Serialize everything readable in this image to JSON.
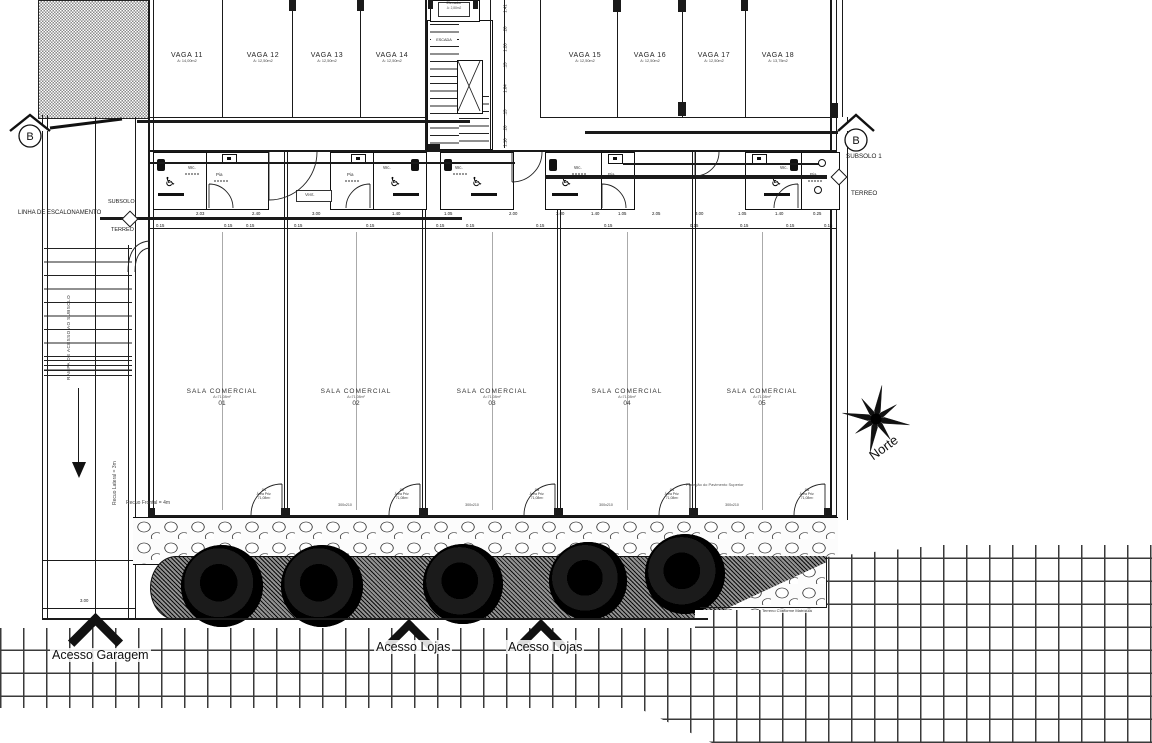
{
  "section_marker": "B",
  "site": {
    "north_label": "Norte",
    "terrain_note": "Terreno Conforme Matrícula",
    "access_garage": "Acesso Garagem",
    "access_shops_1": "Acesso Lojas",
    "access_shops_2": "Acesso Lojas",
    "setback_lateral": "Recuo Lateral = 3m",
    "setback_frontal": "Recuo Frontal = 4m",
    "left_bottom_dim": "3.00"
  },
  "levels": {
    "left_line_label": "LINHA DE ESCALONAMENTO",
    "left_above": "SUBSOLO",
    "left_below": "TERREO",
    "right_above": "SUBSOLO 1",
    "right_below": "TERREO"
  },
  "garage": {
    "ramp_label": "RAMPA DE ACESSO AO SUBSOLO",
    "spaces": [
      {
        "name": "VAGA 11",
        "area": "A: 14,00m2"
      },
      {
        "name": "VAGA 12",
        "area": "A: 12,50m2"
      },
      {
        "name": "VAGA 13",
        "area": "A: 12,50m2"
      },
      {
        "name": "VAGA 14",
        "area": "A: 12,50m2"
      },
      {
        "name": "VAGA 15",
        "area": "A: 12,50m2"
      },
      {
        "name": "VAGA 16",
        "area": "A: 12,50m2"
      },
      {
        "name": "VAGA 17",
        "area": "A: 12,50m2"
      },
      {
        "name": "VAGA 18",
        "area": "A: 13,75m2"
      }
    ]
  },
  "core": {
    "elevator_label": "Elevador",
    "elevator_area": "A: 2,88m2",
    "stair_label": "ESCADA"
  },
  "bathrooms": {
    "wc_label": "Wc.",
    "pia_label": "Pia",
    "vent_label": "Vent."
  },
  "rooms": {
    "title": "SALA COMERCIAL",
    "area": "A=71,08m²",
    "numbers": [
      "01",
      "02",
      "03",
      "04",
      "05"
    ],
    "projection_note": "Projeção do Pavimento Superior",
    "door_tag_title": "Área Priv.",
    "door_tag_area": "71,08m²",
    "window_size": "300x210"
  },
  "dims": {
    "bottom_values": [
      {
        "x": 196,
        "v": "2.03"
      },
      {
        "x": 252,
        "v": "2.40"
      },
      {
        "x": 312,
        "v": "3.00"
      },
      {
        "x": 392,
        "v": "1.40"
      },
      {
        "x": 444,
        "v": "1.05"
      },
      {
        "x": 509,
        "v": "2.00"
      },
      {
        "x": 556,
        "v": "3.00"
      },
      {
        "x": 591,
        "v": "1.40"
      },
      {
        "x": 618,
        "v": "1.05"
      },
      {
        "x": 652,
        "v": "2.05"
      },
      {
        "x": 695,
        "v": "3.00"
      },
      {
        "x": 738,
        "v": "1.05"
      },
      {
        "x": 775,
        "v": "1.40"
      },
      {
        "x": 813,
        "v": "0.25"
      }
    ],
    "bottom_small": [
      {
        "x": 156,
        "v": "0.15"
      },
      {
        "x": 224,
        "v": "0.15"
      },
      {
        "x": 246,
        "v": "0.15"
      },
      {
        "x": 294,
        "v": "0.15"
      },
      {
        "x": 366,
        "v": "0.15"
      },
      {
        "x": 436,
        "v": "0.15"
      },
      {
        "x": 466,
        "v": "0.15"
      },
      {
        "x": 536,
        "v": "0.15"
      },
      {
        "x": 604,
        "v": "0.15"
      },
      {
        "x": 690,
        "v": "0.15"
      },
      {
        "x": 740,
        "v": "0.15"
      },
      {
        "x": 786,
        "v": "0.15"
      },
      {
        "x": 824,
        "v": "0.15"
      }
    ],
    "stair_right": [
      {
        "x": 497,
        "y": 6,
        "v": "1.41"
      },
      {
        "x": 497,
        "y": 27,
        "v": ".20"
      },
      {
        "x": 497,
        "y": 45,
        "v": "1.20"
      },
      {
        "x": 497,
        "y": 63,
        "v": ".15"
      },
      {
        "x": 497,
        "y": 86,
        "v": "1.04"
      },
      {
        "x": 497,
        "y": 110,
        "v": ".15"
      },
      {
        "x": 497,
        "y": 126,
        "v": ".20"
      },
      {
        "x": 497,
        "y": 140,
        "v": "1.10"
      }
    ]
  }
}
